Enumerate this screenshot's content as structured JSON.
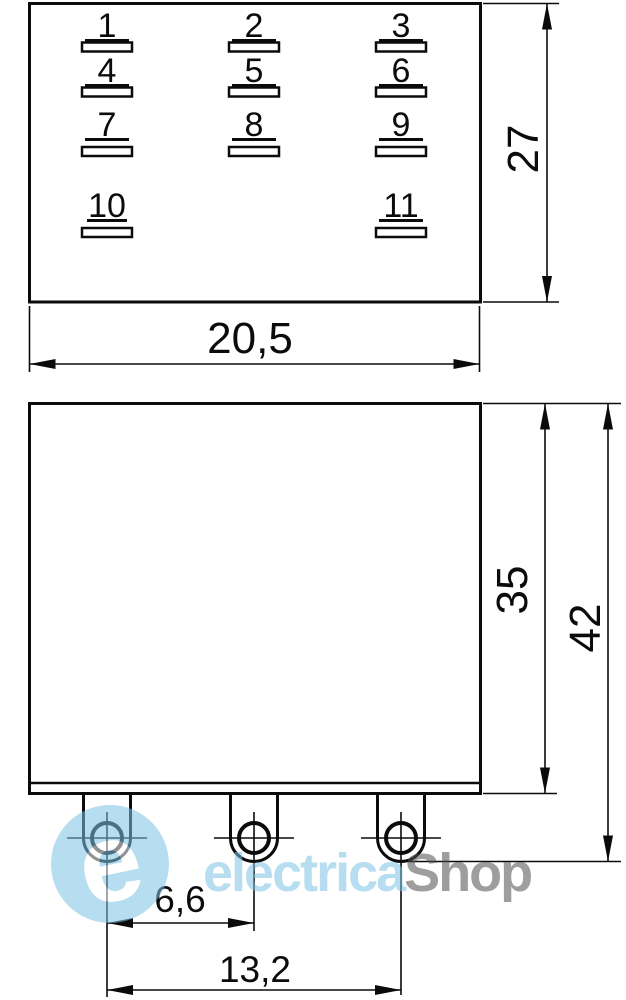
{
  "drawing": {
    "type": "relay-dimensional-drawing",
    "views": {
      "top_view": {
        "description": "pin layout view",
        "pin_labels": [
          "1",
          "2",
          "3",
          "4",
          "5",
          "6",
          "7",
          "8",
          "9",
          "10",
          "11"
        ]
      },
      "side_view": {
        "description": "side elevation with solder pins"
      }
    },
    "dimensions": {
      "top_width": "20,5",
      "top_height": "27",
      "body_height": "35",
      "overall_height": "42",
      "pin_pitch": "6,6",
      "pin_span": "13,2"
    }
  },
  "watermark": {
    "logo_letter": "e",
    "brand_primary": "electrica",
    "brand_secondary": "Shop",
    "accent_color": "#7ec3e6",
    "secondary_color": "#4f4f4f"
  }
}
